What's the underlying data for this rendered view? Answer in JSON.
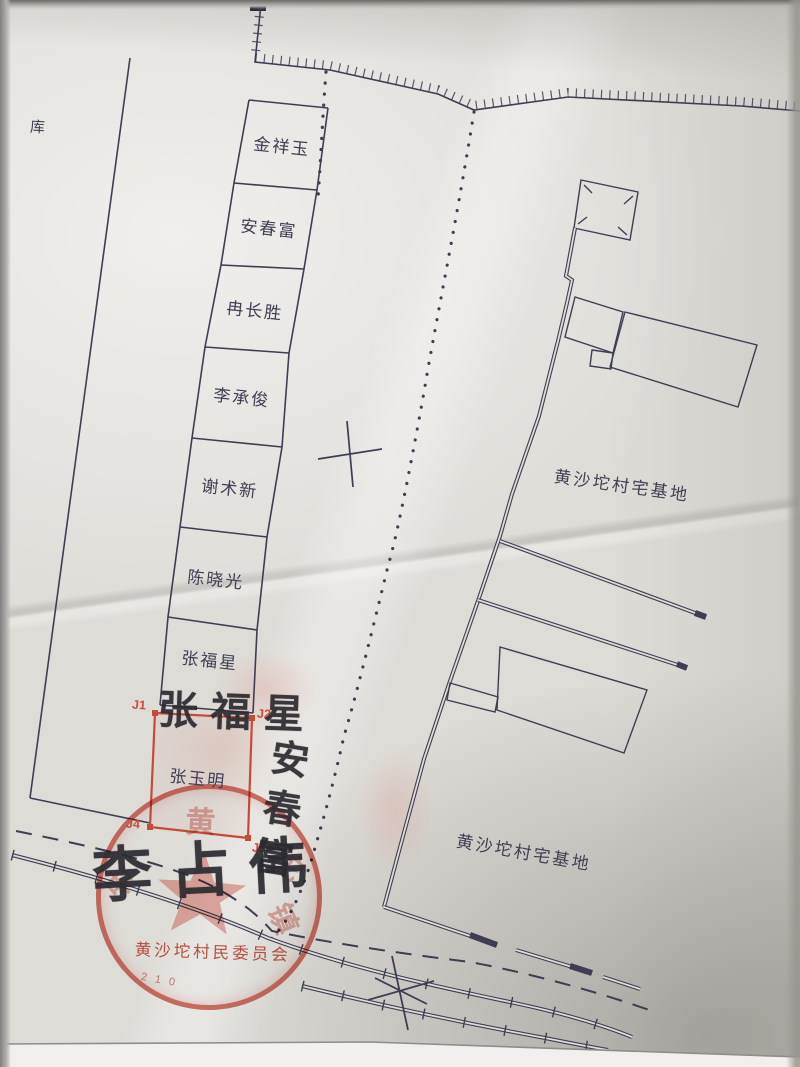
{
  "map": {
    "warehouse_label": "库",
    "plot_names": [
      "金祥玉",
      "安春富",
      "冉长胜",
      "李承俊",
      "谢术新",
      "陈晓光",
      "张福星",
      "张玉明"
    ],
    "corner_labels": {
      "j1": "J1",
      "j2": "J2",
      "j3": "J3",
      "j4": "J4"
    },
    "site_label_upper": "黄沙坨村宅基地",
    "site_label_lower": "黄沙坨村宅基地"
  },
  "signatures": {
    "zhang_fuxing": "张福星",
    "an_chunfu": "安春富",
    "li_zhanwei": "李占伟"
  },
  "stamp": {
    "bottom_text": "黄沙坨村民委员会",
    "digits": "210",
    "arc_chars": [
      "中",
      "黄",
      "坨",
      "镇"
    ],
    "color": "#cc4a3c"
  },
  "colors": {
    "ink": "#3f3d53",
    "red": "#c64a38",
    "paper": "#dedcd7"
  }
}
